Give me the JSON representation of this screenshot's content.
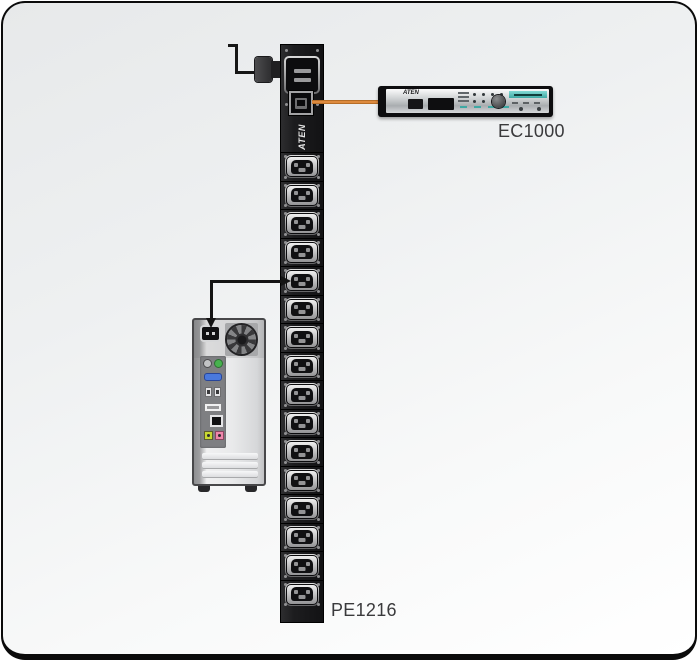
{
  "diagram": {
    "title": "PDU connection diagram",
    "pdu": {
      "brand_label": "ATEN",
      "model_label": "PE1216",
      "outlet_count": 16,
      "body_color": "#1d1d1f"
    },
    "controller": {
      "brand_label": "ATEN",
      "model_label": "EC1000",
      "accent_color": "#3fa9a4"
    },
    "cables": {
      "controller_link_color": "#dd8a3e",
      "power_cord_color": "#161616"
    },
    "computer": {
      "ps2_port_green": "#47b24e",
      "vga_port_blue": "#4a79dd",
      "audio_jack_lime": "#c8d832",
      "audio_jack_pink": "#ef86ab"
    }
  }
}
